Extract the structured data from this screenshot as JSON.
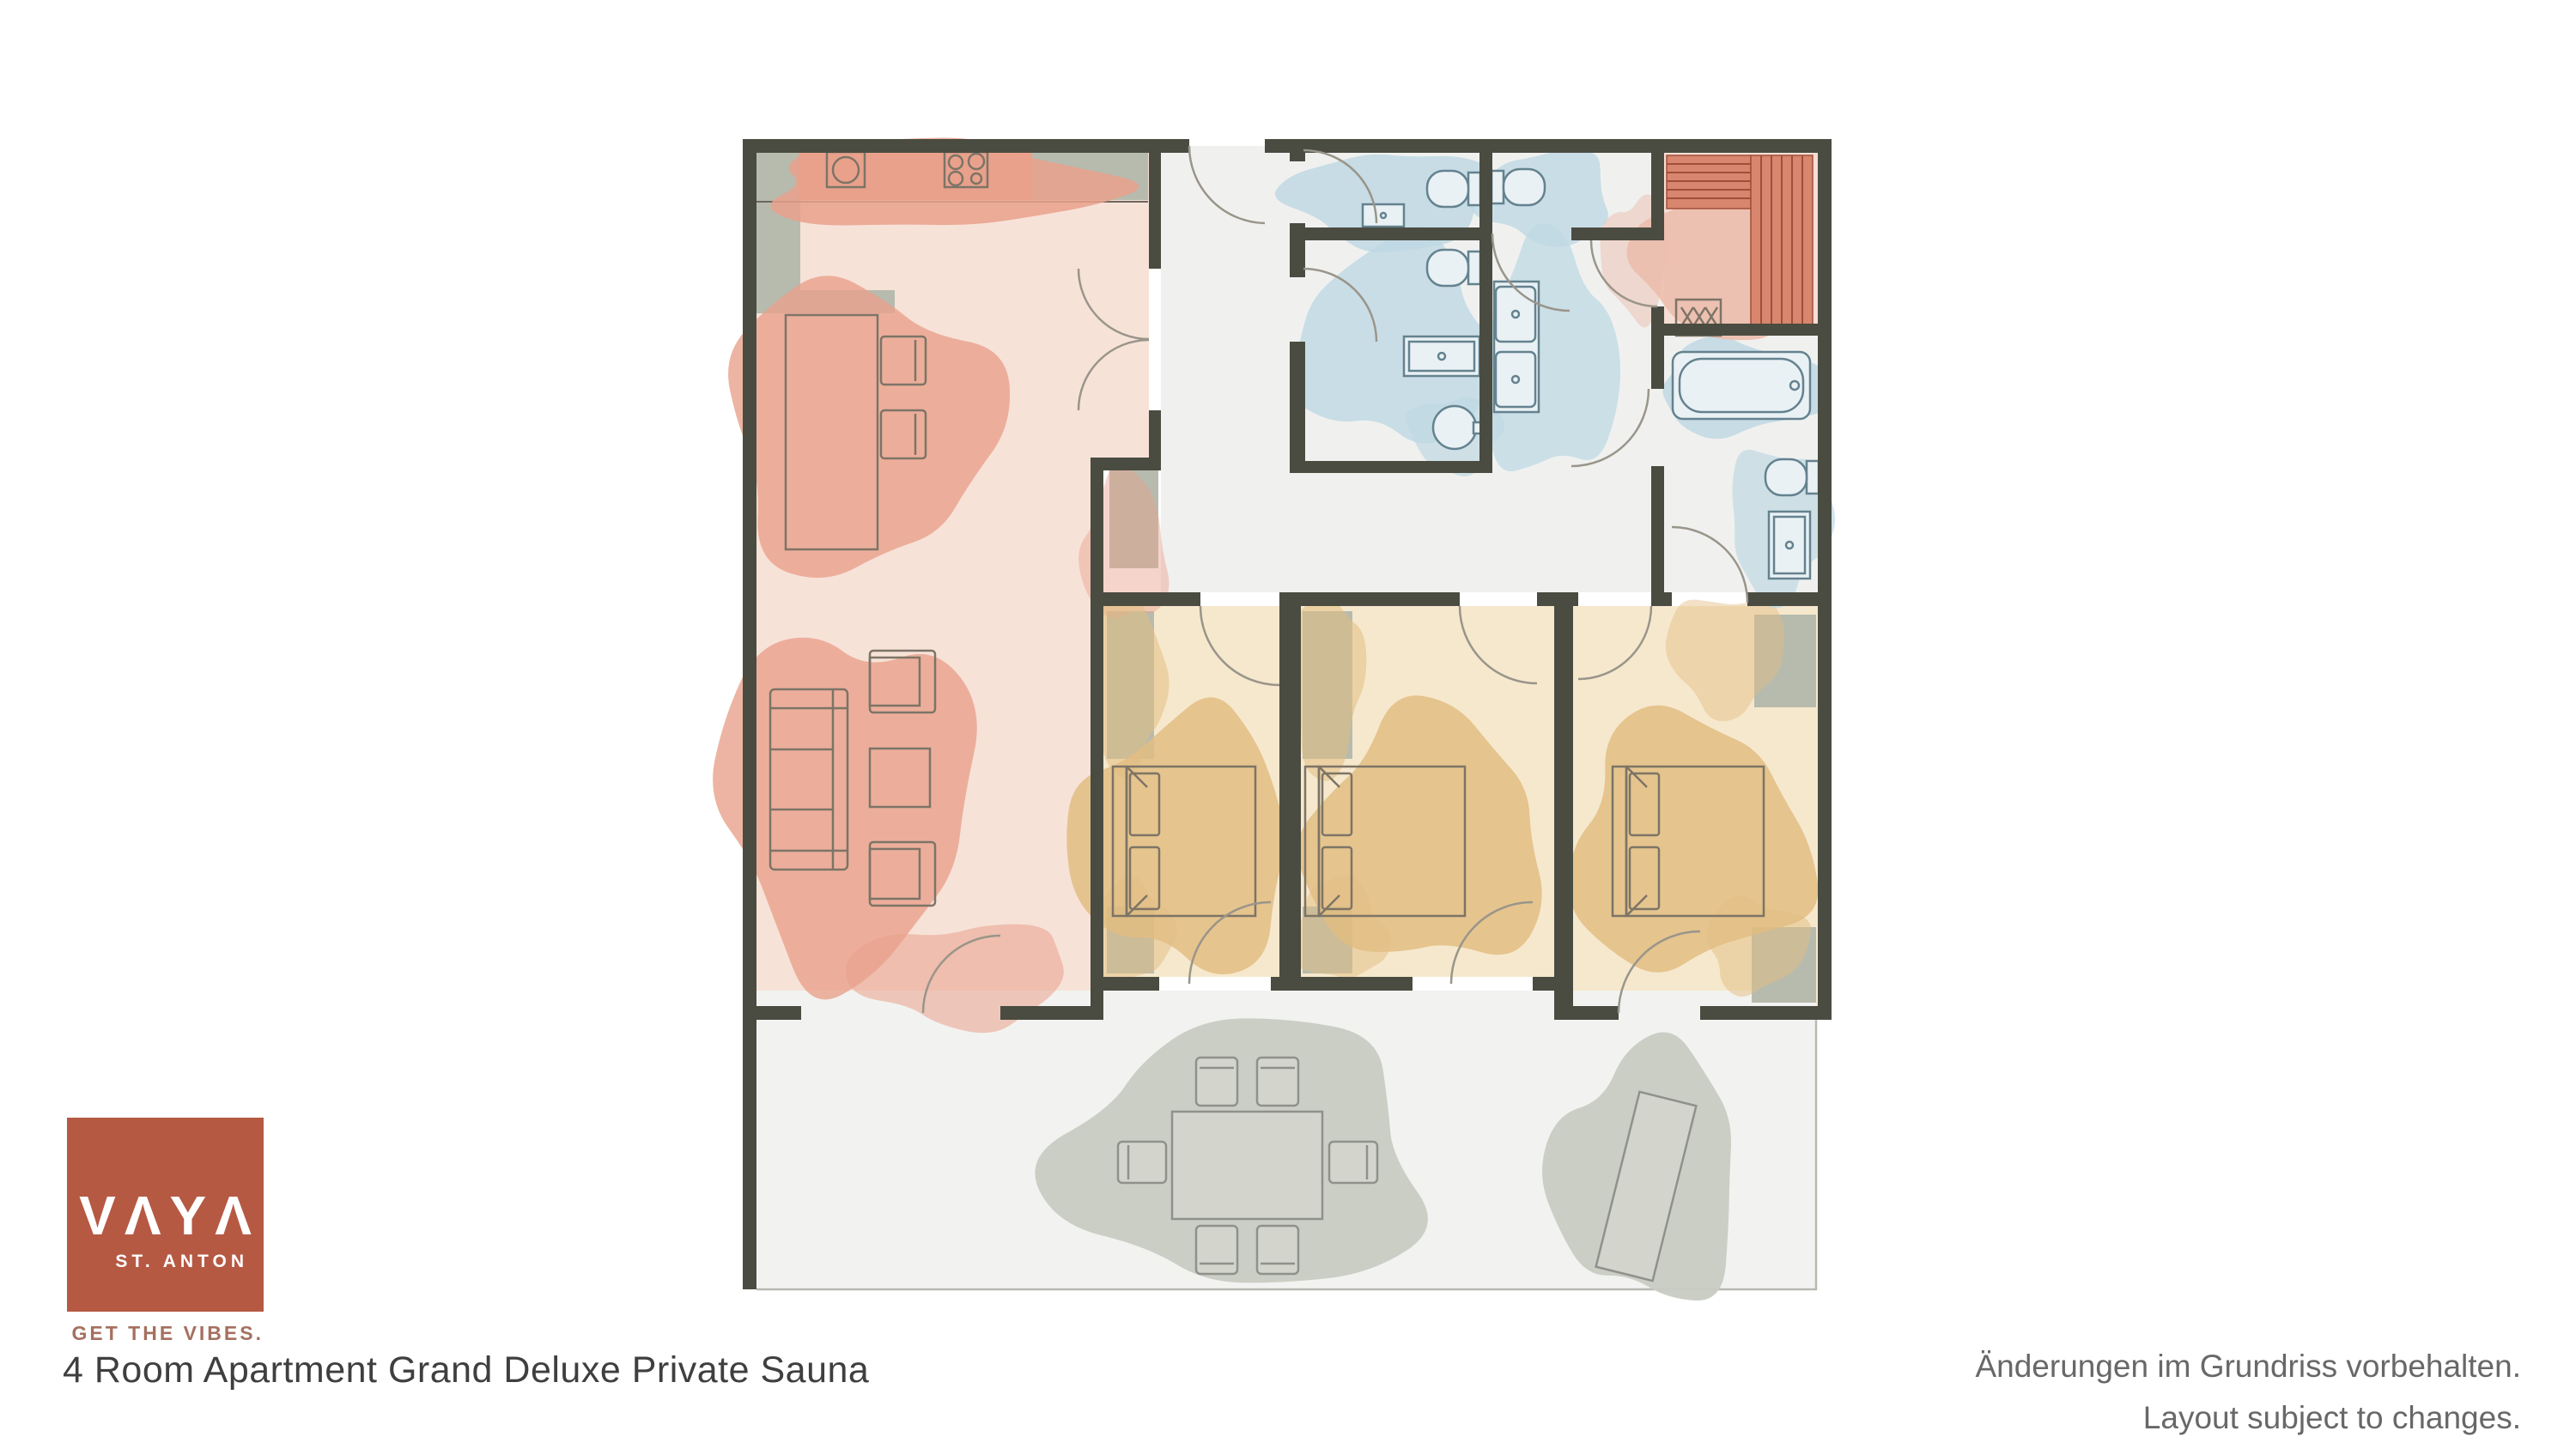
{
  "branding": {
    "logo_text": "VΛYΛ",
    "logo_location": "ST. ANTON",
    "tagline": "GET THE VIBES.",
    "brand_color": "#b65943"
  },
  "title": "4 Room Apartment Grand Deluxe Private Sauna",
  "disclaimer": {
    "line1": "Änderungen im Grundriss vorbehalten.",
    "line2": "Layout subject to changes."
  },
  "floor_plan": {
    "rooms": [
      "living-kitchen-dining",
      "entrance-hall",
      "wc-1",
      "wc-2",
      "shower-room",
      "washroom",
      "private-sauna",
      "bathroom",
      "bedroom-1",
      "bedroom-2",
      "bedroom-3",
      "terrace"
    ],
    "colors": {
      "walls": "#4a4c41",
      "living_wash": "#f7e2d8",
      "living_blob": "#e9a18c",
      "bedroom_wash": "#f6e8cd",
      "bedroom_blob": "#e2bd82",
      "bathroom_blob": "#bfd8e3",
      "sauna_bench": "#d8866d",
      "sauna_wash": "#f6ded4",
      "cabinet_gray": "#b7bbae",
      "terrace_blob": "#c8cbc2",
      "hall_floor": "#f0f1ef"
    }
  }
}
